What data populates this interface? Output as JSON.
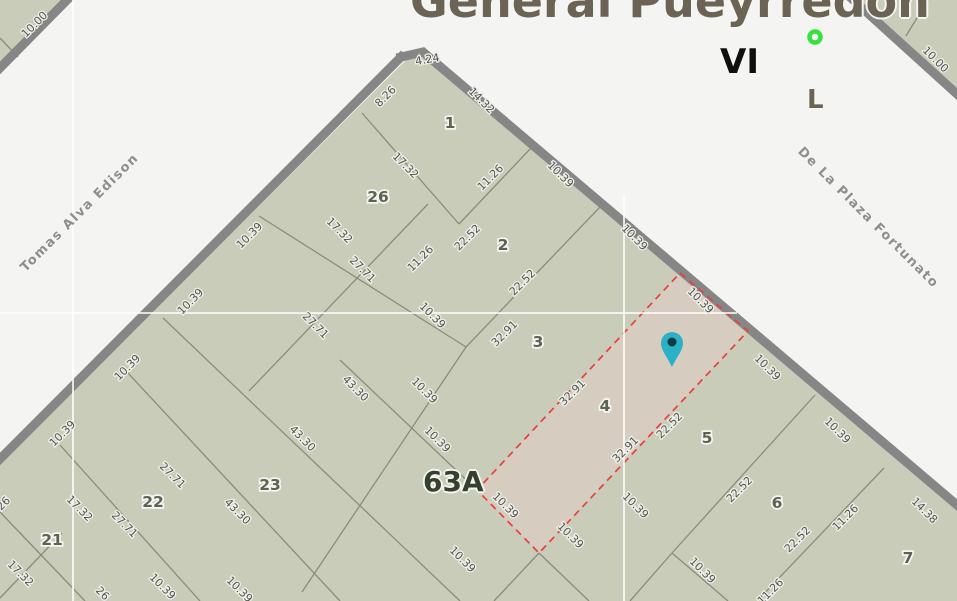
{
  "title": "General Pueyrredon",
  "district_labels": {
    "roman": "VI",
    "letter": "L"
  },
  "block_label": "63A",
  "selected_parcel": "4",
  "streets": [
    {
      "name": "Tomas Alva Edison"
    },
    {
      "name": "De La Plaza Fortunato"
    }
  ],
  "colors": {
    "street_bg": "#f4f4f3",
    "block_fill": "#c8ccb8",
    "highlight_fill": "#d6cdc0",
    "highlight_border": "#e8413c",
    "road": "#868686",
    "parcel_line": "#8a8d7c",
    "marker_teal": "#29b2c6",
    "marker_teal_dot": "#123b41",
    "marker_green": "#35e23c",
    "title_color": "#6b6353"
  },
  "parcel_labels": [
    {
      "t": "1",
      "x": 450,
      "y": 128
    },
    {
      "t": "2",
      "x": 503,
      "y": 250
    },
    {
      "t": "3",
      "x": 538,
      "y": 347
    },
    {
      "t": "4",
      "x": 605,
      "y": 411
    },
    {
      "t": "5",
      "x": 707,
      "y": 443
    },
    {
      "t": "6",
      "x": 777,
      "y": 508
    },
    {
      "t": "7",
      "x": 908,
      "y": 563
    },
    {
      "t": "21",
      "x": 52,
      "y": 545
    },
    {
      "t": "22",
      "x": 153,
      "y": 507
    },
    {
      "t": "23",
      "x": 270,
      "y": 490
    },
    {
      "t": "26",
      "x": 378,
      "y": 202
    }
  ],
  "dimension_labels": [
    {
      "t": "10.00",
      "x": 37,
      "y": 27,
      "r": -45
    },
    {
      "t": "10.00",
      "x": 933,
      "y": 62,
      "r": 45
    },
    {
      "t": "4.24",
      "x": 428,
      "y": 63,
      "r": -10
    },
    {
      "t": "8.26",
      "x": 388,
      "y": 99,
      "r": -45
    },
    {
      "t": "14.32",
      "x": 479,
      "y": 103,
      "r": 45
    },
    {
      "t": "17.32",
      "x": 403,
      "y": 168,
      "r": 45
    },
    {
      "t": "11.26",
      "x": 493,
      "y": 180,
      "r": -45
    },
    {
      "t": "10.39",
      "x": 558,
      "y": 177,
      "r": 45
    },
    {
      "t": "17.32",
      "x": 337,
      "y": 233,
      "r": 45
    },
    {
      "t": "11.26",
      "x": 423,
      "y": 261,
      "r": -45
    },
    {
      "t": "22.52",
      "x": 470,
      "y": 240,
      "r": -45
    },
    {
      "t": "10.39",
      "x": 632,
      "y": 240,
      "r": 45
    },
    {
      "t": "22.52",
      "x": 525,
      "y": 285,
      "r": -45
    },
    {
      "t": "10.39",
      "x": 430,
      "y": 318,
      "r": 45
    },
    {
      "t": "32.91",
      "x": 507,
      "y": 336,
      "r": -45
    },
    {
      "t": "27.71",
      "x": 360,
      "y": 272,
      "r": 45
    },
    {
      "t": "27.71",
      "x": 313,
      "y": 328,
      "r": 45
    },
    {
      "t": "10.39",
      "x": 252,
      "y": 238,
      "r": -45
    },
    {
      "t": "10.39",
      "x": 193,
      "y": 304,
      "r": -45
    },
    {
      "t": "10.39",
      "x": 130,
      "y": 370,
      "r": -45
    },
    {
      "t": "10.39",
      "x": 65,
      "y": 436,
      "r": -45
    },
    {
      "t": "43.30",
      "x": 353,
      "y": 391,
      "r": 45
    },
    {
      "t": "43.30",
      "x": 300,
      "y": 441,
      "r": 45
    },
    {
      "t": "10.39",
      "x": 422,
      "y": 393,
      "r": 45
    },
    {
      "t": "10.39",
      "x": 435,
      "y": 442,
      "r": 45
    },
    {
      "t": "10.39",
      "x": 698,
      "y": 303,
      "r": 45
    },
    {
      "t": "32.91",
      "x": 575,
      "y": 395,
      "r": -45
    },
    {
      "t": "32.91",
      "x": 628,
      "y": 452,
      "r": -45
    },
    {
      "t": "22.52",
      "x": 672,
      "y": 428,
      "r": -45
    },
    {
      "t": "22.52",
      "x": 742,
      "y": 492,
      "r": -45
    },
    {
      "t": "10.39",
      "x": 765,
      "y": 370,
      "r": 45
    },
    {
      "t": "10.39",
      "x": 835,
      "y": 433,
      "r": 45
    },
    {
      "t": "22.52",
      "x": 800,
      "y": 542,
      "r": -45
    },
    {
      "t": "11.26",
      "x": 848,
      "y": 520,
      "r": -45
    },
    {
      "t": "14.38",
      "x": 922,
      "y": 513,
      "r": 45
    },
    {
      "t": "10.39",
      "x": 503,
      "y": 508,
      "r": 45
    },
    {
      "t": "10.39",
      "x": 568,
      "y": 538,
      "r": 45
    },
    {
      "t": "10.39",
      "x": 633,
      "y": 508,
      "r": 45
    },
    {
      "t": "10.39",
      "x": 700,
      "y": 573,
      "r": 45
    },
    {
      "t": "10.39",
      "x": 460,
      "y": 562,
      "r": 45
    },
    {
      "t": "43.30",
      "x": 235,
      "y": 514,
      "r": 45
    },
    {
      "t": "27.71",
      "x": 170,
      "y": 478,
      "r": 45
    },
    {
      "t": "27.71",
      "x": 122,
      "y": 527,
      "r": 45
    },
    {
      "t": "17.32",
      "x": 77,
      "y": 511,
      "r": 45
    },
    {
      "t": "17.32",
      "x": 18,
      "y": 576,
      "r": 45
    },
    {
      "t": "10.39",
      "x": 160,
      "y": 589,
      "r": 45
    },
    {
      "t": "10.39",
      "x": 237,
      "y": 592,
      "r": 45
    },
    {
      "t": "26",
      "x": 100,
      "y": 596,
      "r": 45
    },
    {
      "t": "26",
      "x": 6,
      "y": 506,
      "r": -45
    },
    {
      "t": "11.26",
      "x": 773,
      "y": 594,
      "r": -45
    }
  ]
}
